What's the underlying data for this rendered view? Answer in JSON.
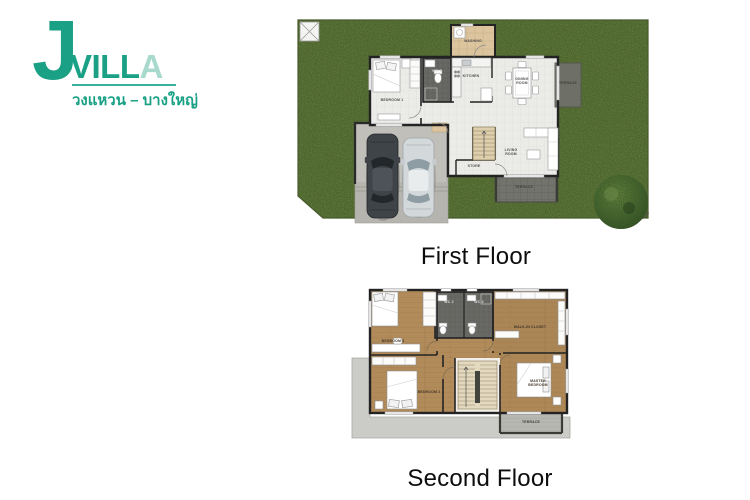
{
  "logo": {
    "j": "J",
    "villa": "VILL",
    "villa_accent": "A",
    "subtitle": "วงแหวน – บางใหญ่",
    "brand_color": "#19a085",
    "accent_color": "#a7dacc"
  },
  "first_floor": {
    "caption": "First Floor",
    "rooms": {
      "washing": "WASHING",
      "wc1": "WC 1",
      "kitchen": "KITCHEN",
      "dining": "DINING ROOM",
      "terrace_side": "TERRACE",
      "bedroom1": "BEDROOM 1",
      "living": "LIVING ROOM",
      "store": "STORE",
      "terrace_bottom": "TERRACE"
    }
  },
  "second_floor": {
    "caption": "Second Floor",
    "rooms": {
      "wc2": "WC 2",
      "wc3": "WC 3",
      "walkin": "WALK-IN CLOSET",
      "bedroom3": "BEDROOM 3",
      "bedroom2": "BEDROOM 2",
      "master": "MASTER BEDROOM",
      "terrace": "TERRACE"
    }
  },
  "colors": {
    "grass": "#5e7338",
    "tile": "#ebebe8",
    "wood": "#b18b59",
    "wc_floor": "#686864",
    "washing_floor": "#dcc59e",
    "driveway": "#b6b4ae",
    "terrace_dark": "#70706a",
    "wall": "#232323"
  }
}
